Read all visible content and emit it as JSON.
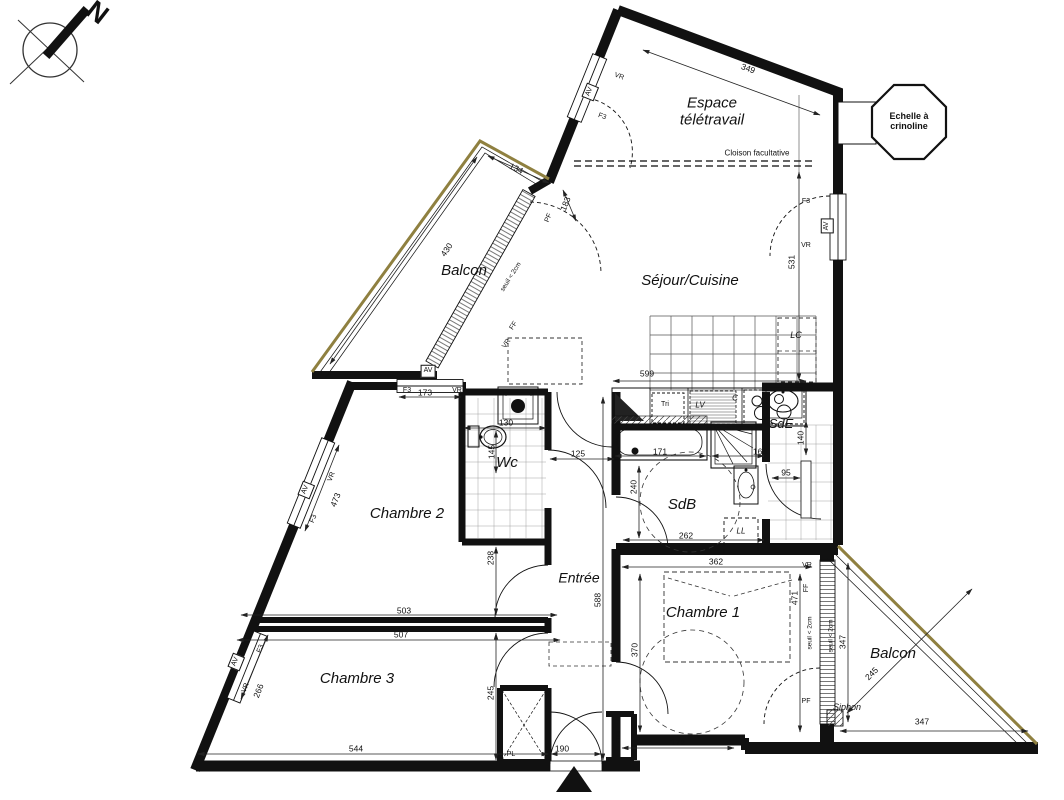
{
  "plan": {
    "compass": {
      "north": "N"
    },
    "rooms": {
      "espace": "Espace télétravail",
      "sejour": "Séjour/Cuisine",
      "balcon_nw": "Balcon",
      "balcon_se": "Balcon",
      "chambre1": "Chambre 1",
      "chambre2": "Chambre 2",
      "chambre3": "Chambre 3",
      "entree": "Entrée",
      "wc": "Wc",
      "sdb": "SdB",
      "sde": "SdE"
    },
    "fixtures": {
      "lc": "LC",
      "tri": "Tri",
      "lv": "LV",
      "hob": "C",
      "ll": "LL",
      "pl": "PL",
      "etel": "ETEL",
      "siphon": "Siphon"
    },
    "window_tags": {
      "av": "AV",
      "vr": "VR",
      "f3": "F3",
      "pf": "PF",
      "ff": "FF"
    },
    "notes": {
      "cloison": "Cloison facultative",
      "echelle": "Echelle à crinoline",
      "seuil": "seuil < 2cm"
    },
    "dimensions": {
      "d349": "349",
      "d531": "531",
      "d134": "134",
      "d430": "430",
      "d173": "173",
      "d183": "183",
      "d473": "473",
      "d266": "266",
      "d503": "503",
      "d507": "507",
      "d544": "544",
      "d238": "238",
      "d145": "145",
      "d130": "130",
      "d125": "125",
      "d588": "588",
      "d190": "190",
      "d245_ch3": "245",
      "d599": "599",
      "d171": "171",
      "d166": "166",
      "d140": "140",
      "d95": "95",
      "d240": "240",
      "d262": "262",
      "d362": "362",
      "d370": "370",
      "d471": "471",
      "d172": "172",
      "d347_v": "347",
      "d347_h": "347",
      "d245_balcon": "245"
    }
  }
}
